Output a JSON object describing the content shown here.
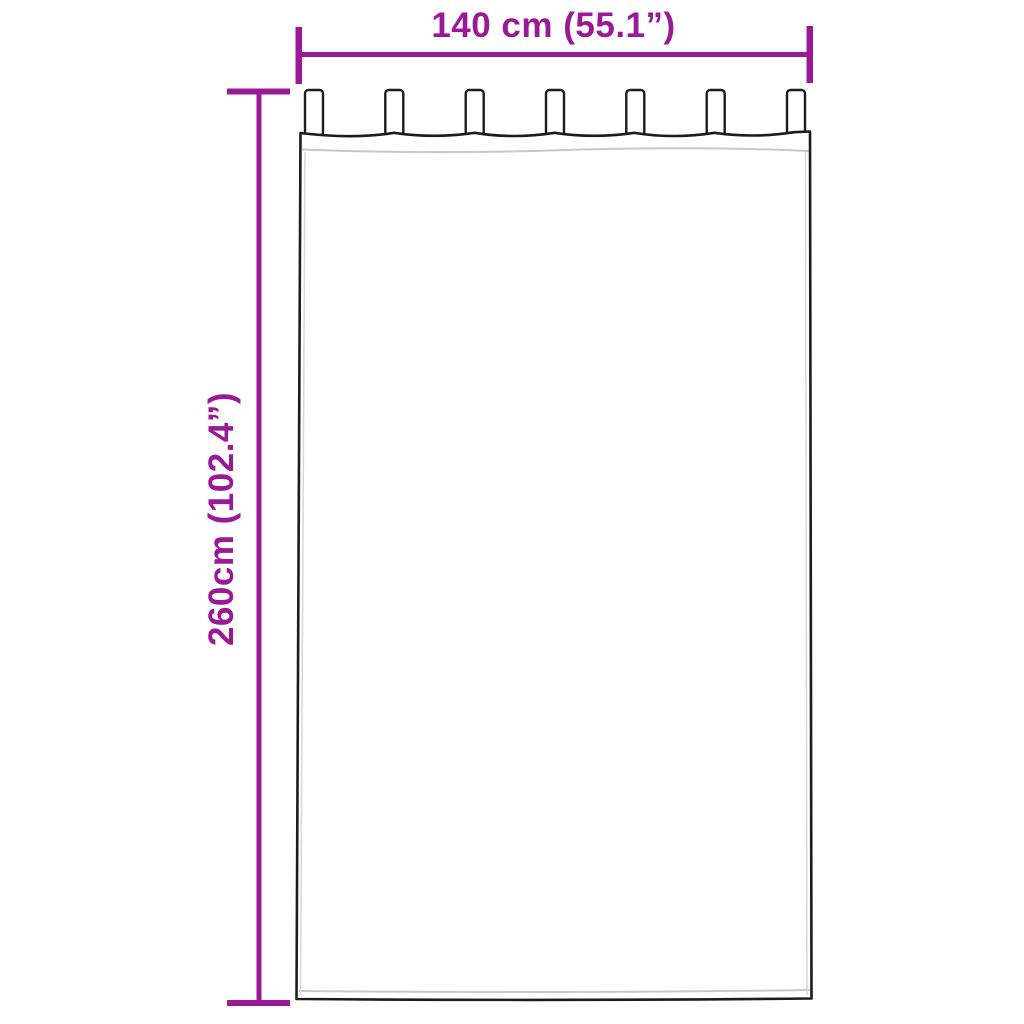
{
  "labels": {
    "width": "140 cm (55.1”)",
    "height": "260cm (102.4”)"
  },
  "curtain": {
    "tab_count": 7
  },
  "colors": {
    "dimension_accent": "#9B1996",
    "curtain_outline": "#1C1C1C",
    "seam_gray": "#C8C8C8",
    "background": "#FFFFFF"
  }
}
